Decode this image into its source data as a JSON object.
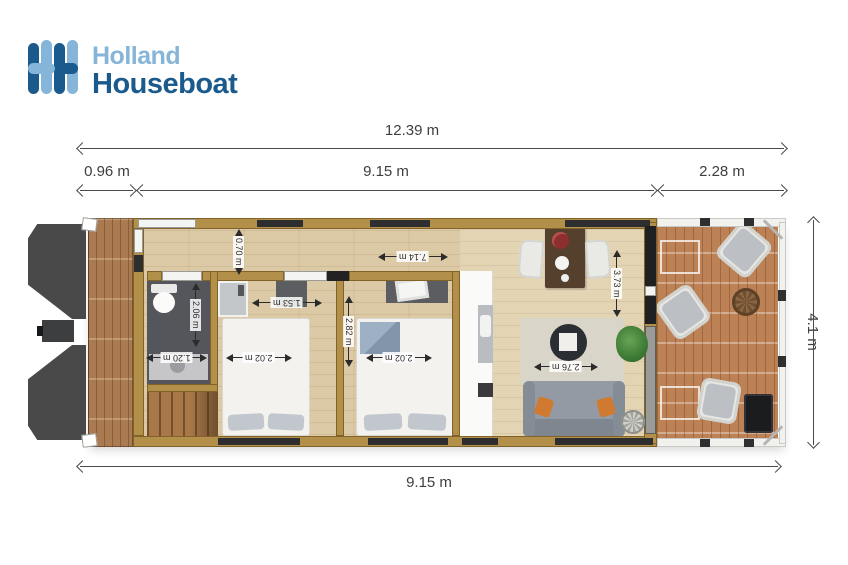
{
  "brand": {
    "name_line1": "Holland",
    "name_line2": "Houseboat",
    "dark_blue": "#1a5a8c",
    "light_blue": "#85b5d8"
  },
  "overall_dimensions": {
    "total_length": "12.39 m",
    "bow_deck_length": "0.96 m",
    "cabin_length_top": "9.15 m",
    "terrace_length": "2.28 m",
    "beam_width": "4.1 m",
    "cabin_length_bottom": "9.15 m"
  },
  "room_dimensions": {
    "hallway_width": "0.70 m",
    "bathroom_length": "2.06 m",
    "bathroom_width": "1.20 m",
    "bedroom1_width": "1.53 m",
    "bedroom1_bed_width": "2.02 m",
    "bedroom2_length": "2.82 m",
    "bedroom2_bed_width": "2.02 m",
    "open_plan_length": "7.14 m",
    "living_room_length": "3.73 m",
    "living_room_width": "2.76 m"
  }
}
